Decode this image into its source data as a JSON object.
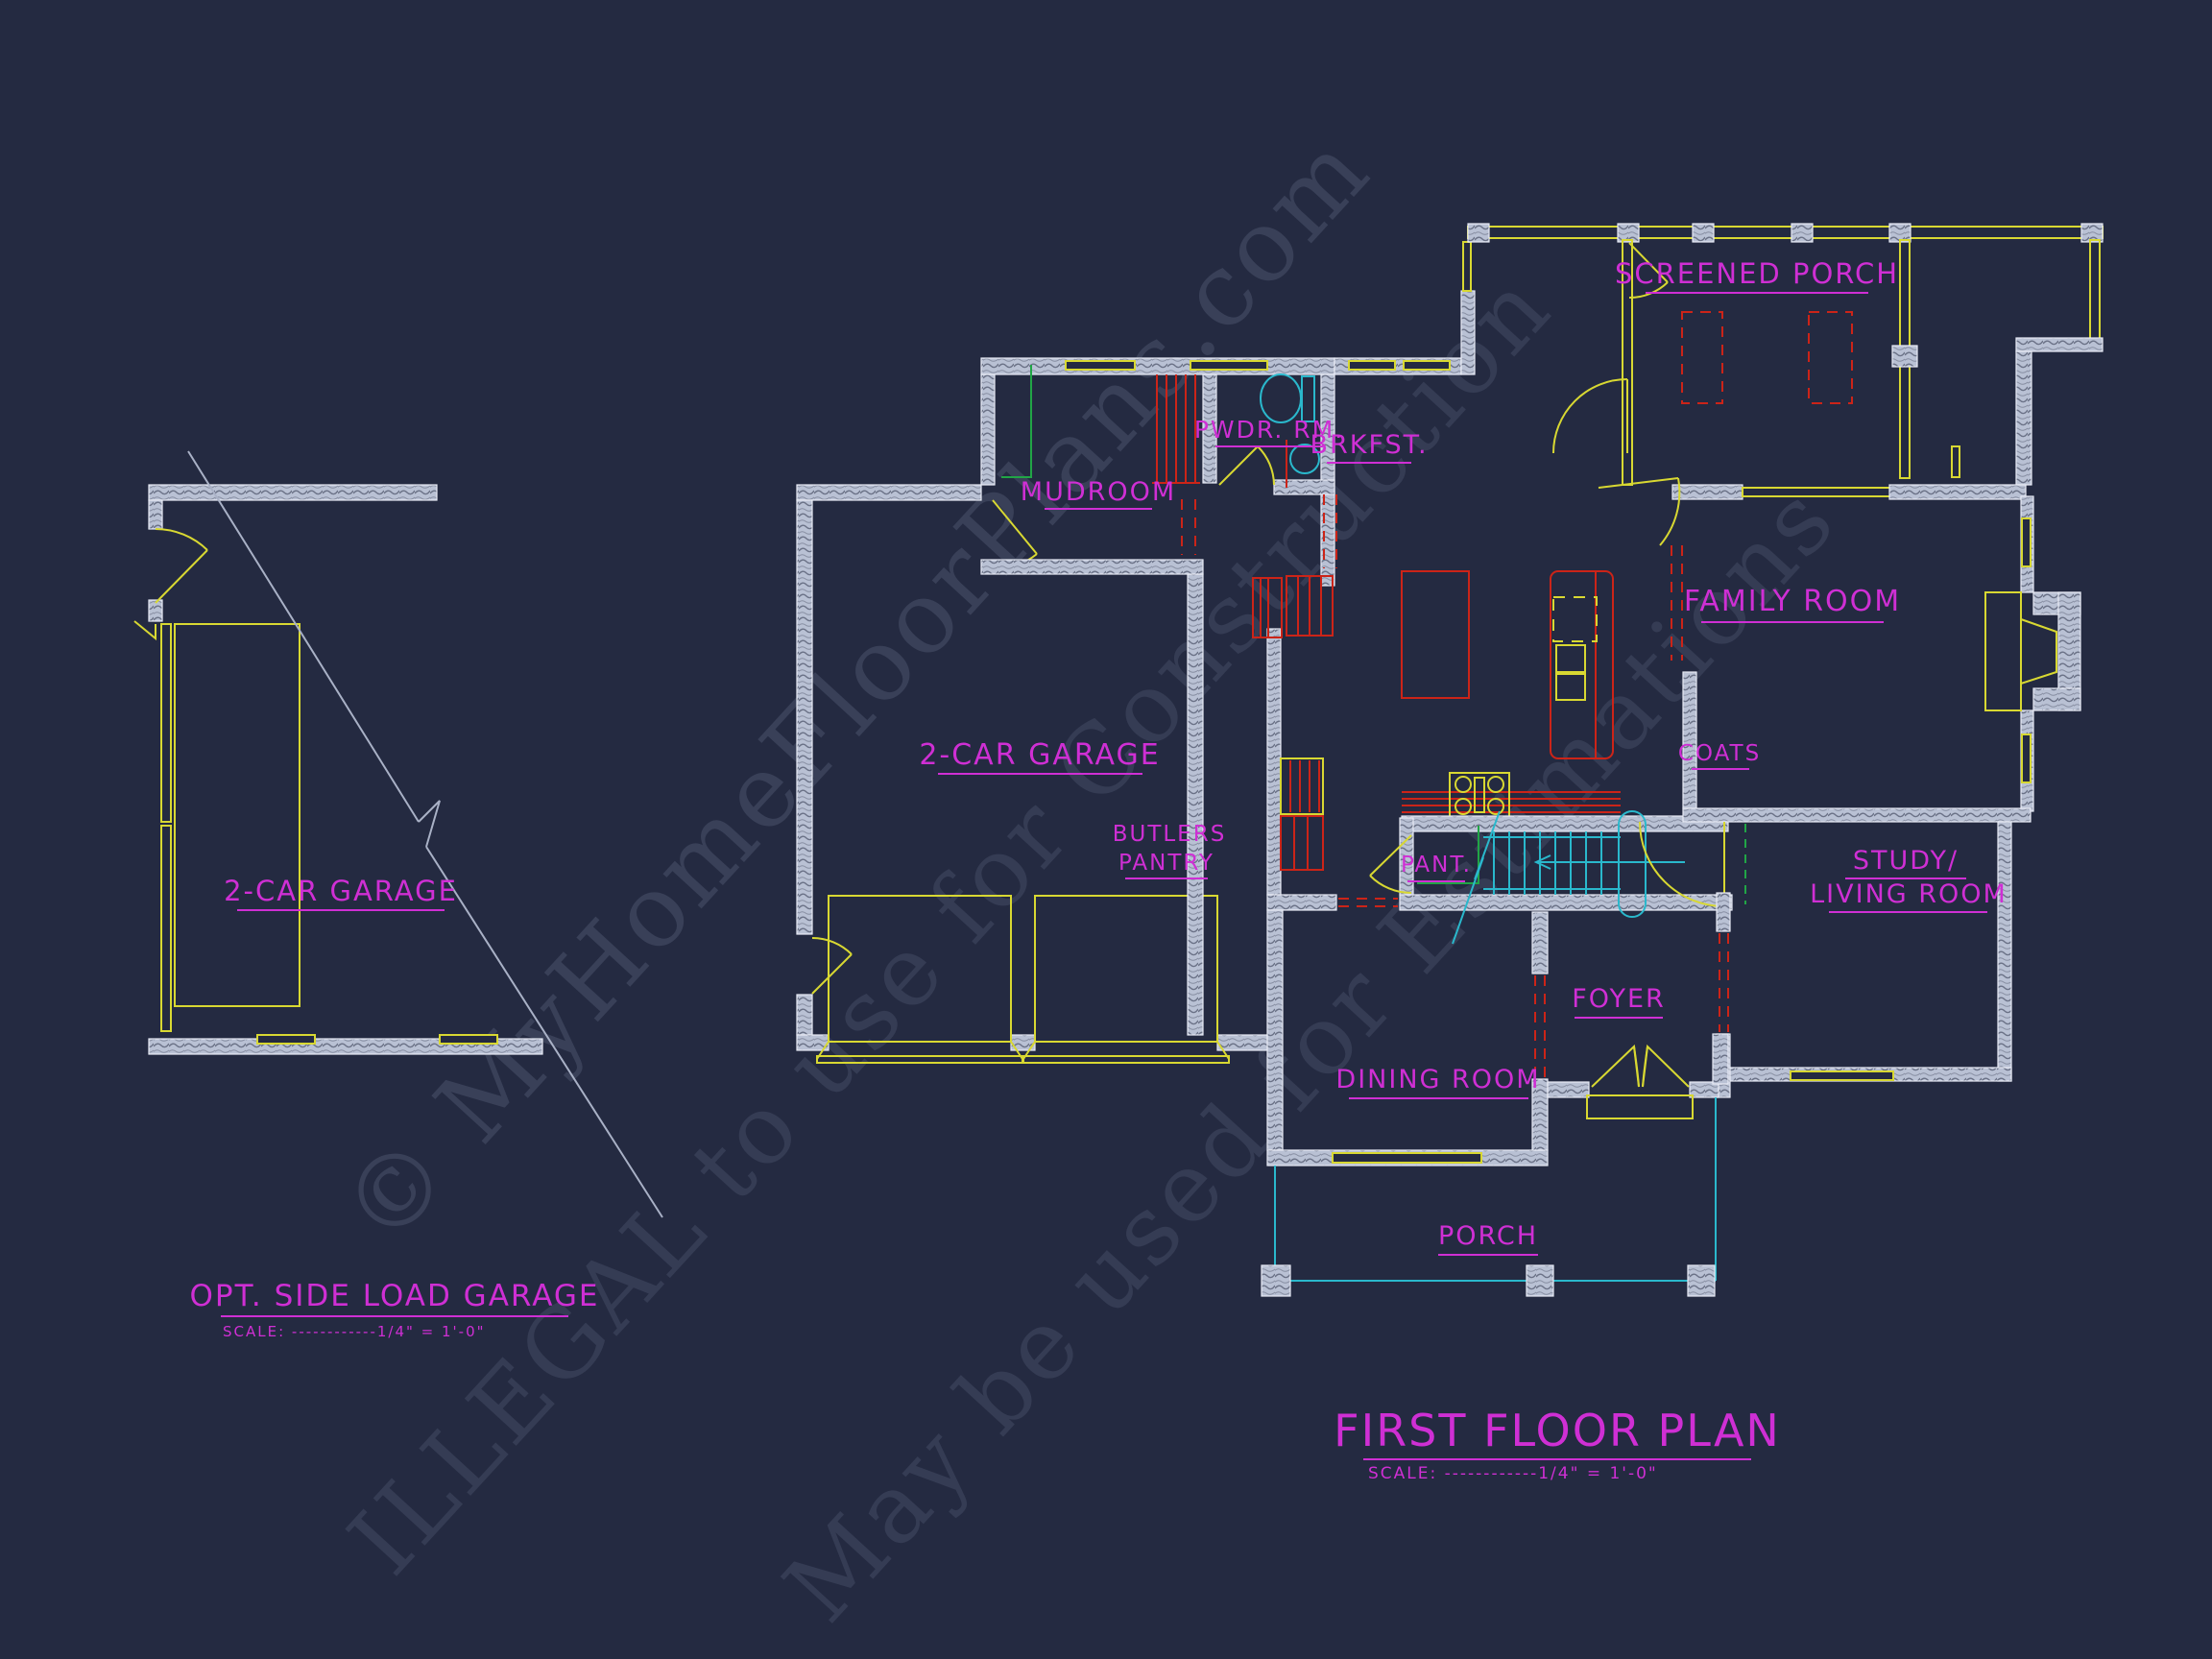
{
  "colors": {
    "bg": "#242a41",
    "magenta": "#cf2fd4",
    "yellow": "#d8d832",
    "red": "#cc2418",
    "cyan": "#2ab8cc",
    "green": "#21a546",
    "wall-edge": "#e8ecf6",
    "grey": "#a9b1c6",
    "watermark": "#8d98b5"
  },
  "labels": {
    "screened_porch": "SCREENED PORCH",
    "brkfst": "BRKFST.",
    "pwdr_rm": "PWDR. RM.",
    "mudroom": "MUDROOM",
    "family_room": "FAMILY ROOM",
    "garage_main": "2-CAR GARAGE",
    "garage_opt": "2-CAR GARAGE",
    "coats": "COATS",
    "butlers_1": "BUTLERS",
    "butlers_2": "PANTRY",
    "pant": "PANT.",
    "study_1": "STUDY/",
    "study_2": "LIVING ROOM",
    "foyer": "FOYER",
    "dining_room": "DINING ROOM",
    "porch": "PORCH"
  },
  "titles": {
    "opt": {
      "name": "OPT. SIDE LOAD GARAGE",
      "scale": "SCALE: ------------1/4\" = 1'-0\""
    },
    "main": {
      "name": "FIRST FLOOR PLAN",
      "scale": "SCALE: ------------1/4\" = 1'-0\""
    }
  },
  "watermark": {
    "line1": "© MyHomeFloorPlans.com",
    "line2": "ILLEGAL to use for Construction",
    "line3": "May be used for Estimations"
  }
}
